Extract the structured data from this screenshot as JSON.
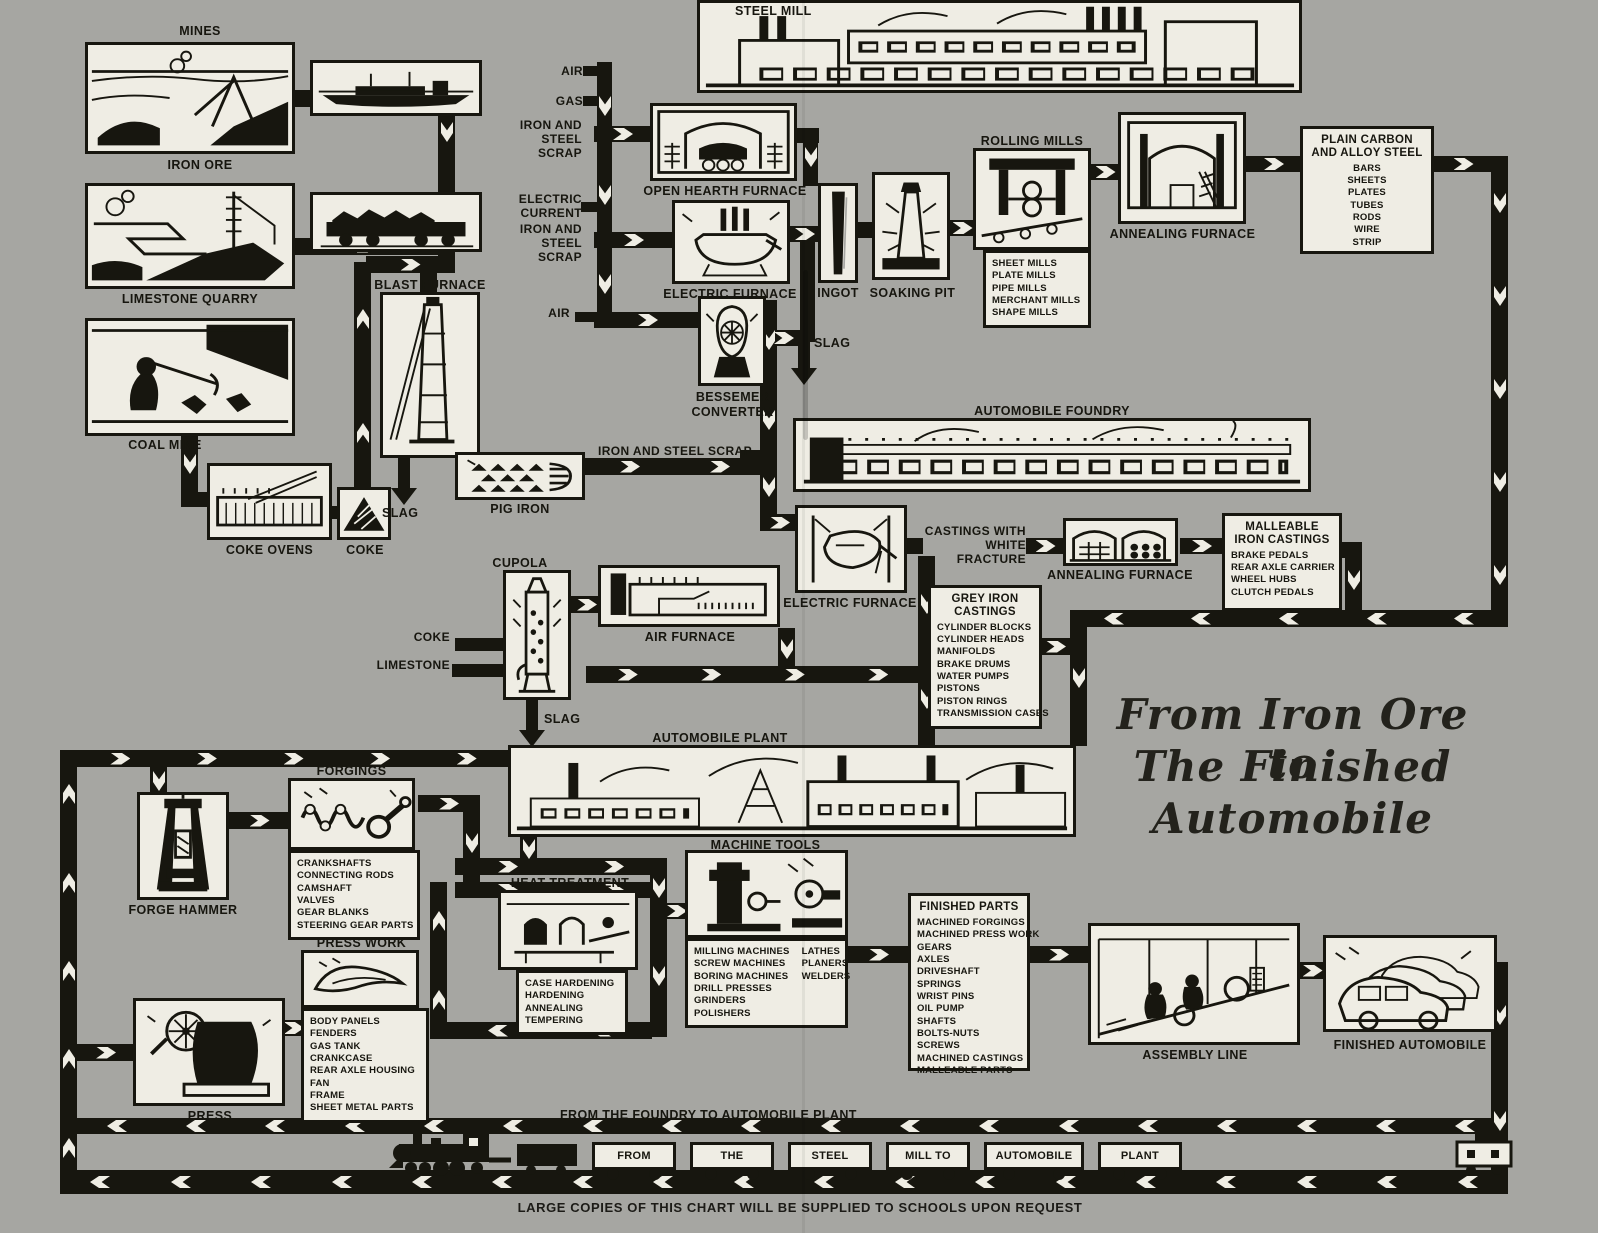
{
  "meta": {
    "background": "#a6a6a2",
    "ink": "#17160f",
    "paper": "#efede4"
  },
  "title": {
    "lines": [
      "From Iron Ore to",
      "The Finished",
      "Automobile"
    ]
  },
  "caption": "LARGE COPIES OF THIS CHART WILL BE SUPPLIED TO SCHOOLS UPON REQUEST",
  "labels": {
    "mines": "MINES",
    "iron_ore": "IRON ORE",
    "limestone_quarry": "LIMESTONE QUARRY",
    "coal_mine": "COAL MINE",
    "coke_ovens": "COKE OVENS",
    "coke": "COKE",
    "blast_furnace": "BLAST FURNACE",
    "slag": "SLAG",
    "pig_iron": "PIG IRON",
    "steel_mill": "STEEL MILL",
    "air": "AIR",
    "gas": "GAS",
    "iron_and_steel_scrap": "IRON AND STEEL SCRAP",
    "electric_current": "ELECTRIC CURRENT",
    "open_hearth_furnace": "OPEN HEARTH FURNACE",
    "electric_furnace": "ELECTRIC FURNACE",
    "bessemer_converter": "BESSEMER CONVERTER",
    "ingot": "INGOT",
    "soaking_pit": "SOAKING PIT",
    "rolling_mills": "ROLLING MILLS",
    "annealing_furnace": "ANNEALING FURNACE",
    "automobile_foundry": "AUTOMOBILE FOUNDRY",
    "castings_with_white_fracture": "CASTINGS WITH WHITE FRACTURE",
    "cupola": "CUPOLA",
    "air_furnace": "AIR FURNACE",
    "limestone": "LIMESTONE",
    "automobile_plant": "AUTOMOBILE PLANT",
    "forgings": "FORGINGS",
    "forge_hammer": "FORGE HAMMER",
    "press_work": "PRESS WORK",
    "press": "PRESS",
    "heat_treatment": "HEAT TREATMENT",
    "machine_tools": "MACHINE TOOLS",
    "assembly_line": "ASSEMBLY LINE",
    "finished_automobile": "FINISHED AUTOMOBILE",
    "foundry_to_plant": "FROM THE FOUNDRY TO AUTOMOBILE PLANT"
  },
  "lists": {
    "rolling_mill_types": [
      "SHEET MILLS",
      "PLATE MILLS",
      "PIPE MILLS",
      "MERCHANT MILLS",
      "SHAPE MILLS"
    ],
    "plain_carbon": {
      "title": "PLAIN CARBON AND ALLOY STEEL",
      "items": [
        "BARS",
        "SHEETS",
        "PLATES",
        "TUBES",
        "RODS",
        "WIRE",
        "STRIP"
      ]
    },
    "grey_iron": {
      "title": "GREY IRON CASTINGS",
      "items": [
        "CYLINDER BLOCKS",
        "CYLINDER HEADS",
        "MANIFOLDS",
        "BRAKE DRUMS",
        "WATER PUMPS",
        "PISTONS",
        "PISTON RINGS",
        "TRANSMISSION CASES"
      ]
    },
    "malleable_iron": {
      "title": "MALLEABLE IRON CASTINGS",
      "items": [
        "BRAKE PEDALS",
        "REAR AXLE CARRIER",
        "WHEEL HUBS",
        "CLUTCH PEDALS"
      ]
    },
    "finished_parts": {
      "title": "FINISHED PARTS",
      "items": [
        "MACHINED FORGINGS",
        "MACHINED PRESS WORK",
        "GEARS",
        "AXLES",
        "DRIVESHAFT",
        "SPRINGS",
        "WRIST PINS",
        "OIL PUMP",
        "SHAFTS",
        "BOLTS-NUTS",
        "SCREWS",
        "MACHINED CASTINGS",
        "MALLEABLE PARTS"
      ]
    },
    "forgings_items": [
      "CRANKSHAFTS",
      "CONNECTING RODS",
      "CAMSHAFT",
      "VALVES",
      "GEAR BLANKS",
      "STEERING GEAR PARTS"
    ],
    "press_work_items": [
      "BODY PANELS",
      "FENDERS",
      "GAS TANK",
      "CRANKCASE",
      "REAR AXLE HOUSING",
      "FAN",
      "FRAME",
      "SHEET METAL PARTS"
    ],
    "heat_treatment_items": [
      "CASE HARDENING",
      "HARDENING",
      "ANNEALING",
      "TEMPERING"
    ],
    "machine_tools_col1": [
      "MILLING MACHINES",
      "SCREW MACHINES",
      "BORING MACHINES",
      "DRILL PRESSES",
      "GRINDERS",
      "POLISHERS"
    ],
    "machine_tools_col2": [
      "LATHES",
      "PLANERS",
      "WELDERS"
    ]
  },
  "train": {
    "words": [
      "FROM",
      "THE",
      "STEEL",
      "MILL TO",
      "AUTOMOBILE",
      "PLANT"
    ]
  }
}
